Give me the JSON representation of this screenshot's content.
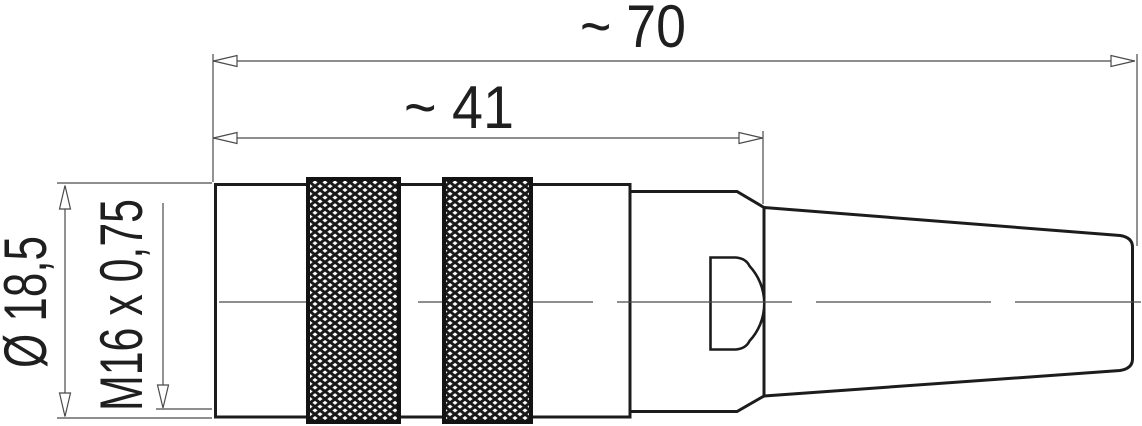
{
  "dimensions": {
    "total_length": "~ 70",
    "body_length": "~ 41",
    "outer_diameter": "Ø 18,5",
    "thread": "M16 x 0,75"
  },
  "colors": {
    "outline": "#1c1c1c",
    "thin_line": "#4a4a4a",
    "background": "#ffffff"
  }
}
